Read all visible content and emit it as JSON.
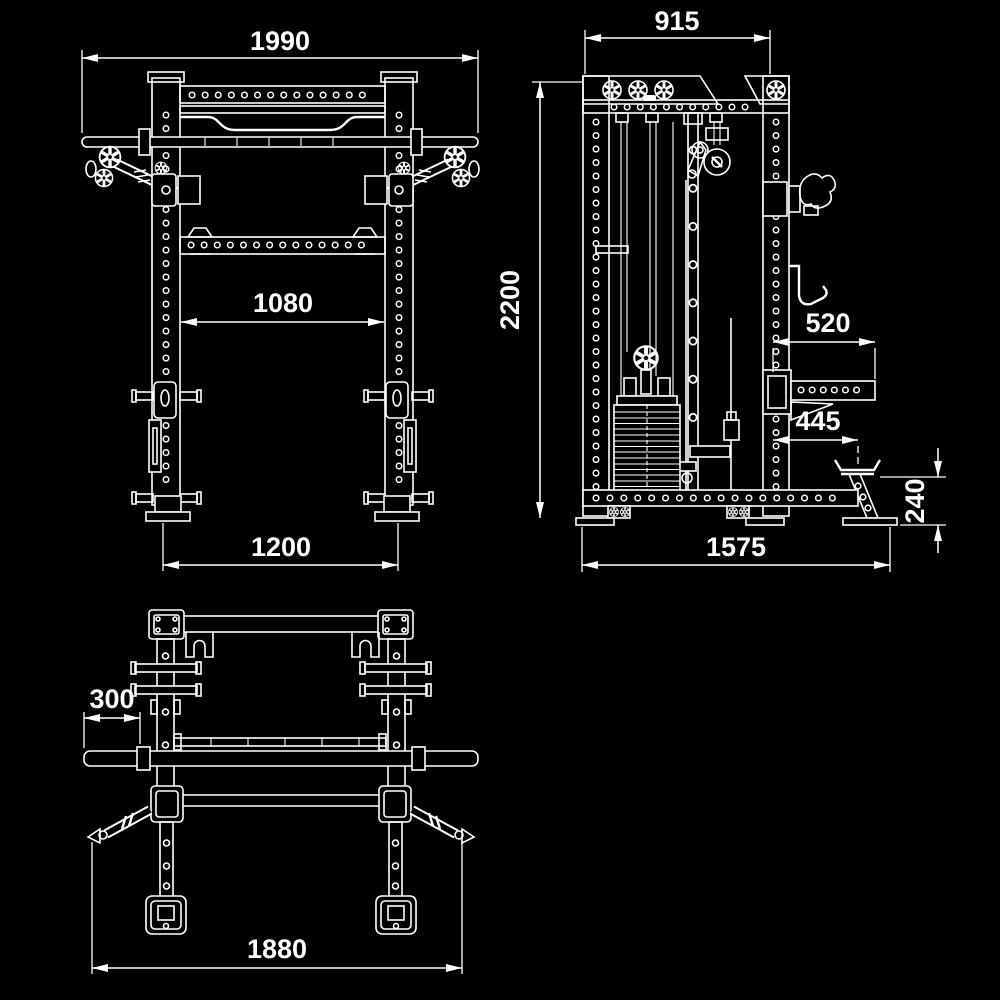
{
  "style": {
    "background": "#000000",
    "line_color": "#ffffff"
  },
  "dimensions": {
    "front_total_width": "1990",
    "front_inner_width": "1080",
    "front_base_width": "1200",
    "side_frame_depth": "915",
    "side_total_height": "2200",
    "side_spotter_arm_length": "520",
    "side_platform_offset": "445",
    "side_platform_height": "240",
    "side_base_depth": "1575",
    "plan_sleeve_length": "300",
    "plan_total_length": "1880"
  }
}
